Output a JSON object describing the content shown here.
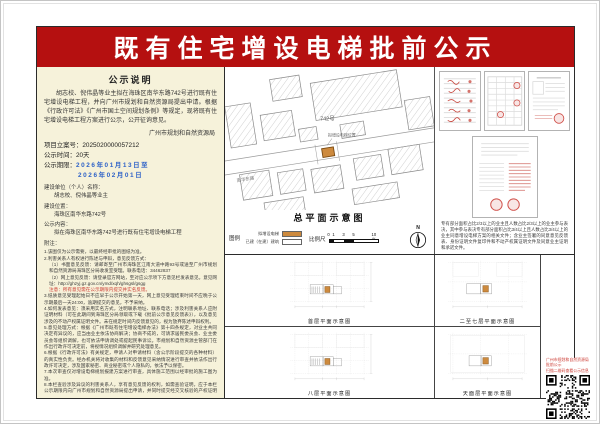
{
  "title": "既有住宅增设电梯批前公示",
  "colors": {
    "banner_red": "#b51010",
    "panel_beige": "#f6f2da",
    "marker_orange": "#cd8a3e",
    "existing_building_white": "#ffffff",
    "date_blue": "#2e62c8",
    "stamp_red": "#cc3b33"
  },
  "left_panel": {
    "heading": "公示说明",
    "intro": "胡志校、倪伟晶等业主拟在海珠区南华东路742号进行既有住宅增设电梯工程，并向广州市规划和自然资源局提出申请。根据《行政许可法》《广州市国土空间规划条例》等规定，现将既有住宅增设电梯工程方案进行公示，公开征询意见。",
    "authority": "广州市规划和自然资源局",
    "project_no_label": "项目立案号：",
    "project_no": "2025020000057212",
    "duration_label": "公示时间：",
    "duration": "20天",
    "period_label": "公示期限：",
    "period_line1": "2026年01月13日至",
    "period_line2": "2026年02月01日",
    "applicant_label": "建设单位（个人）名称：",
    "applicant": "胡志校、倪伟晶等业主",
    "location_label": "建设位置：",
    "location": "海珠区南华东路742号",
    "content_label": "公示内容：",
    "content": "拟在海珠区南华东路742号进行既有住宅增设电梯工程",
    "notes_label": "附注：",
    "notes": [
      "1.该图仅为公示需要，以最终经审批的图纸为准。",
      "2.利害关系人有权进行陈述与申辩，意见反馈方式：",
      "（1）书面意见反馈：请邮寄至广州市海珠区江南大道中路93号或送至广州市规划和自然资源局海珠区分局收发室受理。联系电话：34462837",
      "（2）网上意见反馈：请登录官方网站，至对应公示项下方意见栏发表意见。意见网址：http://ghzyj.gz.gov.cn/ymd/xqh/ghsgsl/gsgg",
      "注意：所有意见需在公示期限内提交并实名反馈。",
      "3.纸质意见受理起始日不应早于公示开始第一天，网上意见受理结束时间不应晚于公示期最后一天24:00，逾期提交的意见，不予采纳。",
      "4.如何发表意见：须采用实名方式，注明联系地址、联系电话；涉及利害关系人应附证明材料（可在此期间到海珠区分局领取或下载《批前公示意见反馈表》），以及意见涉及的不动产权属证明文件。未在规定时间内反馈意见的，视为放弃陈述申辩权利。",
      "5.意见处理方式：根据《广州市既有住宅增设电梯办法》第十四条规定，对业主共同决定有异议的，应当由业主依法协商解决；协商不成的，可请求居民委员会、业主委员会等组织调解，也可依法申请调处或提起民事诉讼。市规划和自然资源主管部门在作出行政许可决定前，将视情况组织调解并研究处理意见。",
      "6.根据《行政许可法》有关规定，申请人对申请材料（含公示阶段提交的各种材料）的真实性负责。经办机关将对收集的材料和反馈意见采纳情况进行审查并依法作出行政许可决定，涉及国家秘密、商业秘密或个人隐私的，依法予以保密。",
      "7.本次审查仅对增设电梯规划报建方案进行审查，具体施工范围以经审批的施工图为准。",
      "8.本栏查验涉及异议的利害关系人，享有意见反馈的权利，如需查验证明，应于本栏公示期限内向广州市规划和自然资源局提出申请，并同时提交经交叉核验的产权证明资料。"
    ]
  },
  "site_plan": {
    "caption": "总平面示意图",
    "legend_label": "图例",
    "legend_items": [
      {
        "label": "拟增设电梯"
      },
      {
        "label": "已建（在建）建筑"
      }
    ],
    "scale_label": "比例尺",
    "scale_ticks": [
      "0",
      "1",
      "3",
      "5",
      "10米"
    ],
    "north_label": "N",
    "map_labels": {
      "building_no": "742号",
      "marker": "拟增设电梯位置",
      "road": "南华东路"
    }
  },
  "documents": {
    "note": "专有部分面积占比2/3以上的业主且人数占比2/3以上的业主参与表决，其中参与表决专有部分面积占比3/4以上且人数占比3/4以上的业主同意增设电梯方案的相关文件；含业主签署的同意意见反馈表、身份证明文件复印件和不动产权属证明文件及同意业主证明和承诺文件。"
  },
  "floor_plans": [
    {
      "caption": "首层平面示意图"
    },
    {
      "caption": "八层平面示意图"
    },
    {
      "caption": "二至七层平面示意图"
    },
    {
      "caption": "天面层平面示意图"
    }
  ],
  "qr": {
    "caption_line1": "广州市规划和自然资源局批前公示",
    "caption_line2": "扫描二维码查看公示信息"
  }
}
